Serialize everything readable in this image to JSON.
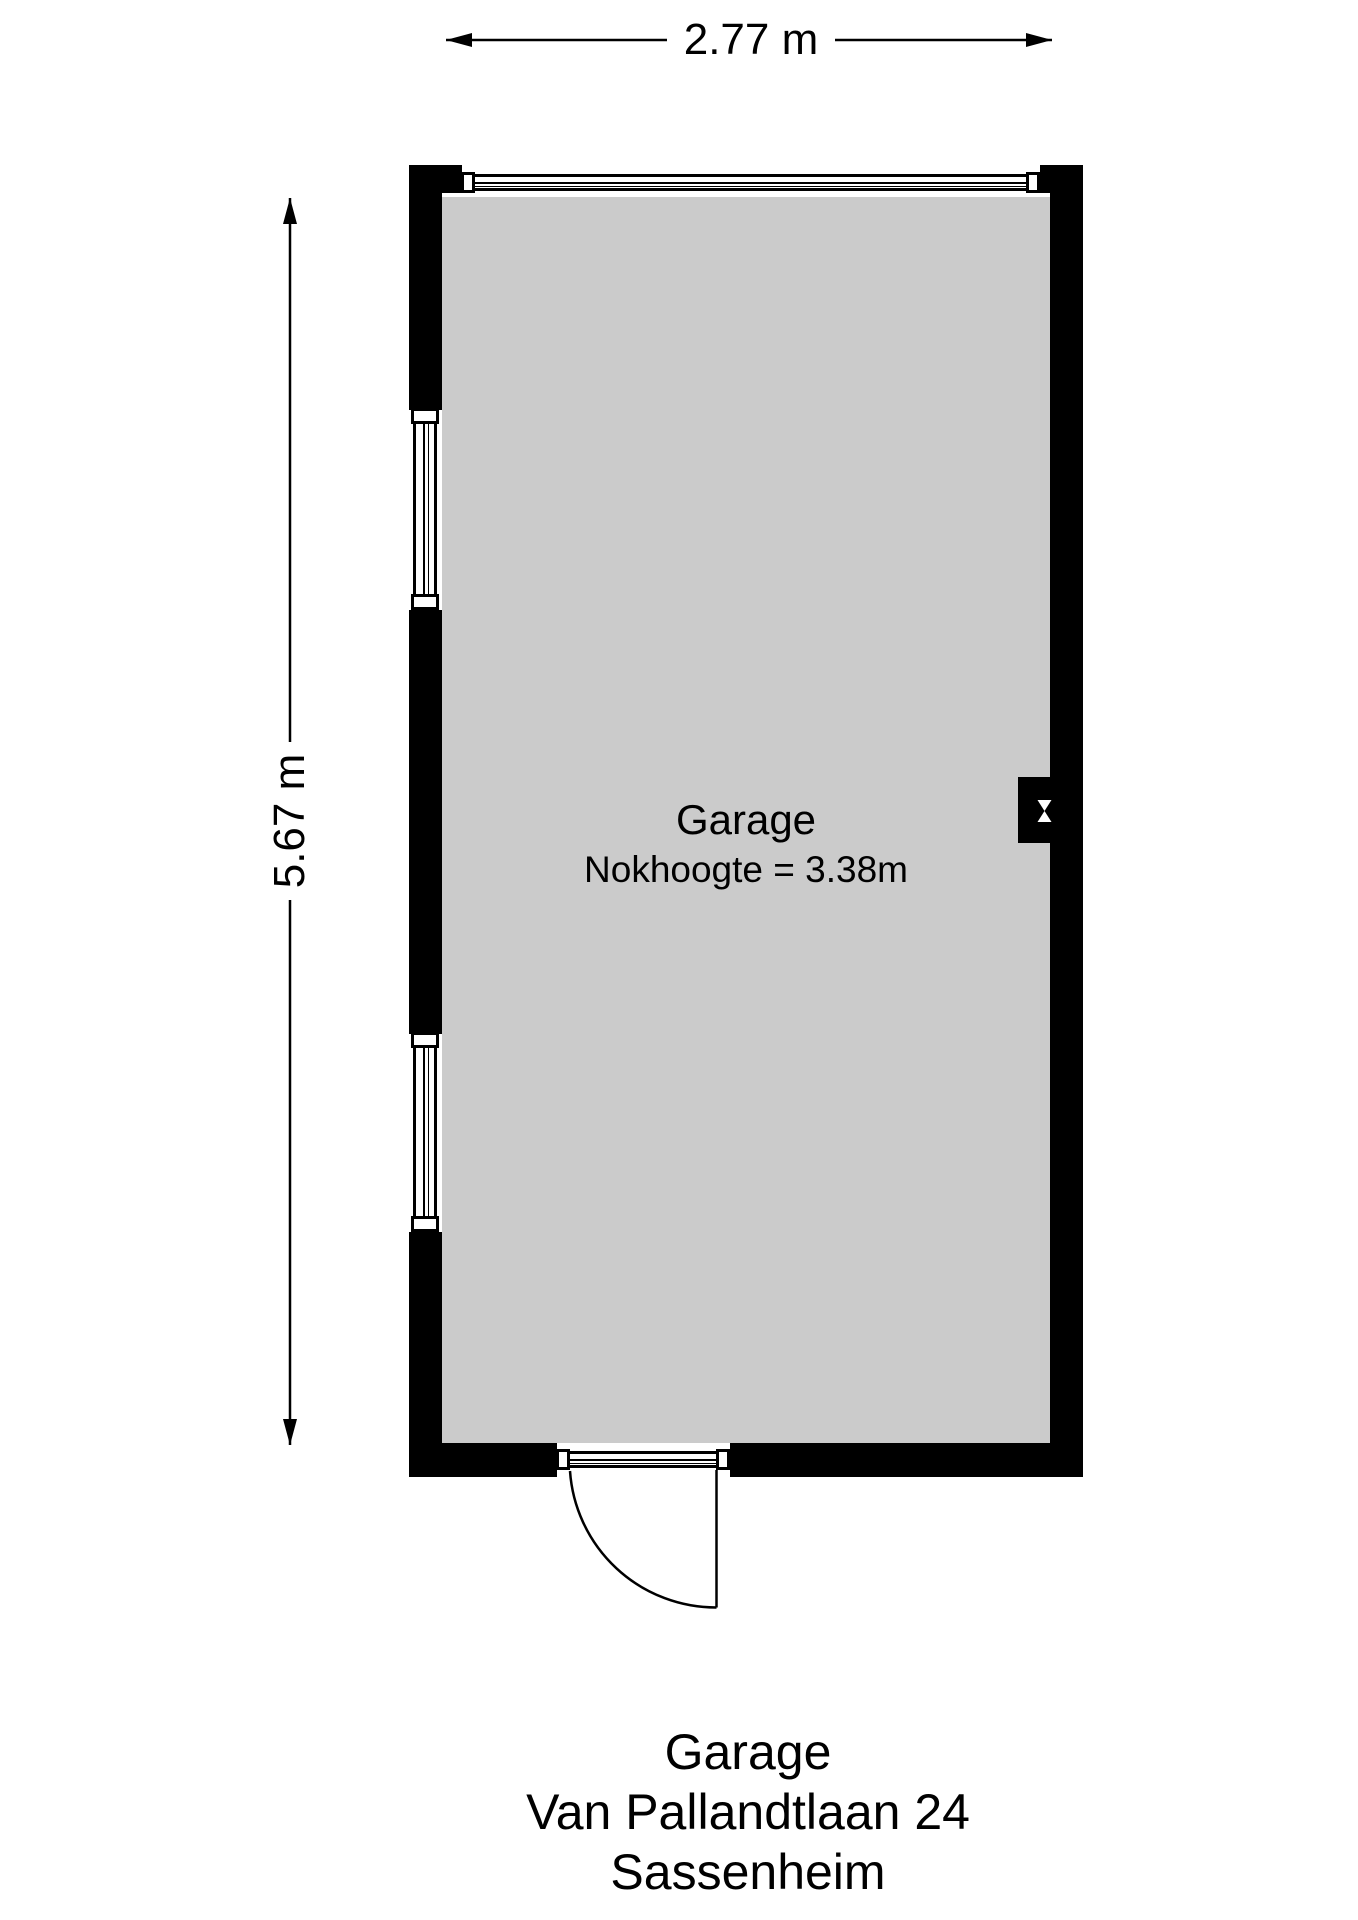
{
  "dimensions": {
    "width_label": "2.77 m",
    "height_label": "5.67 m"
  },
  "room": {
    "name": "Garage",
    "ridge_height": "Nokhoogte = 3.38m"
  },
  "caption": {
    "title": "Garage",
    "address": "Van Pallandtlaan 24",
    "city": "Sassenheim"
  },
  "colors": {
    "wall": "#000000",
    "floor": "#cbcbcb",
    "line": "#000000",
    "background": "#ffffff"
  }
}
